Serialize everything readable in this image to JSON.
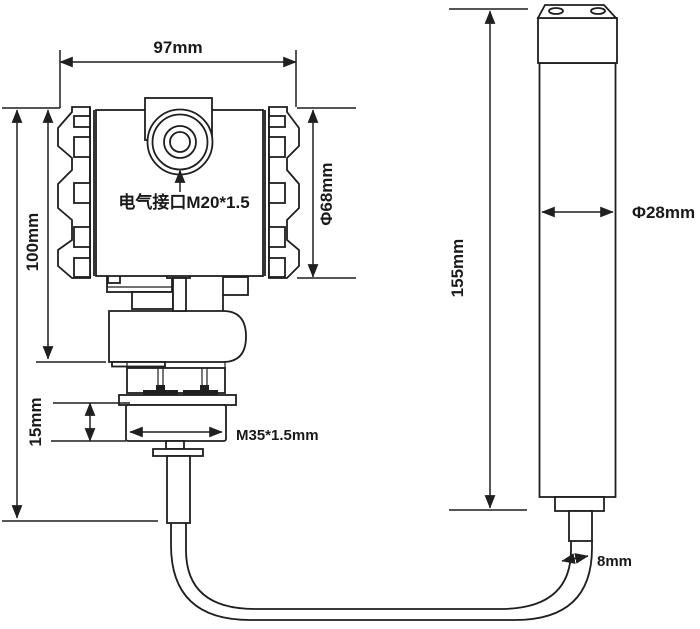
{
  "drawing": {
    "type": "technical-dimension-drawing",
    "background_color": "#ffffff",
    "line_color": "#1f1f1f",
    "text_color": "#1a1a1a",
    "transmitter": {
      "width_label": "97mm",
      "housing_height_label": "100mm",
      "housing_diameter_label": "Φ68mm",
      "electrical_port_label": "电气接口M20*1.5",
      "thread_length_label": "15mm",
      "thread_spec_label": "M35*1.5mm"
    },
    "probe": {
      "length_label": "155mm",
      "diameter_label": "Φ28mm"
    },
    "cable": {
      "diameter_label": "8mm"
    }
  }
}
